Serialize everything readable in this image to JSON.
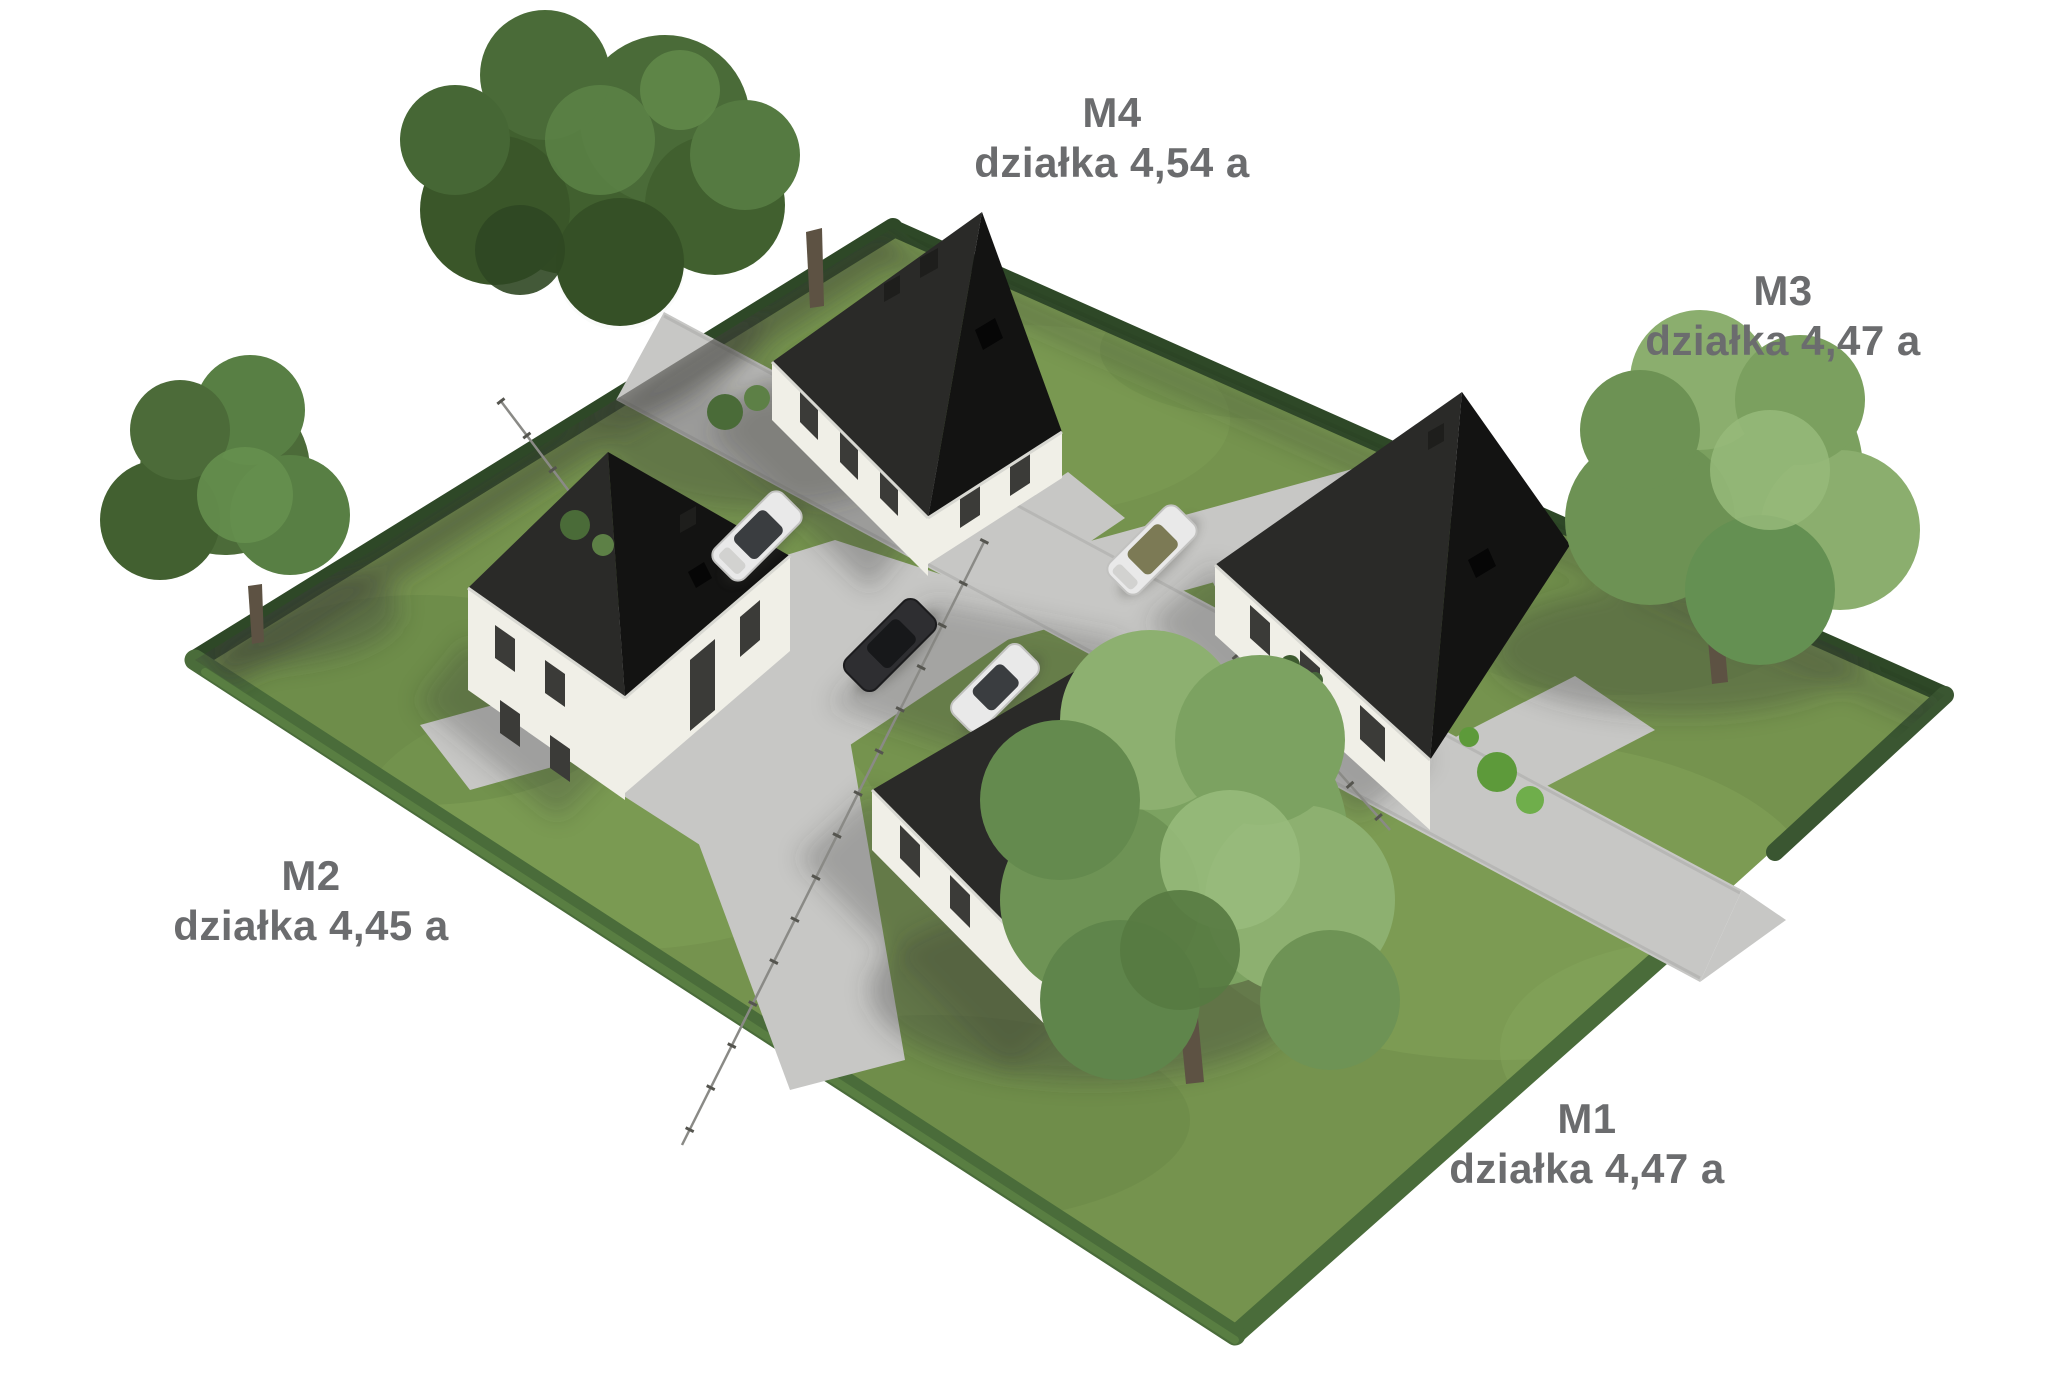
{
  "background": "#ffffff",
  "plots": [
    {
      "id": "M1",
      "label": "M1",
      "area_label": "działka 4,47 a"
    },
    {
      "id": "M2",
      "label": "M2",
      "area_label": "działka 4,45 a"
    },
    {
      "id": "M3",
      "label": "M3",
      "area_label": "działka 4,47 a"
    },
    {
      "id": "M4",
      "label": "M4",
      "area_label": "działka 4,54 a"
    }
  ],
  "colors": {
    "label-text": "#6b6c6e",
    "grass": "#75934e",
    "grass-light": "#8aab5f",
    "grass-dark": "#5e7c40",
    "hedge-dark": "#2e4827",
    "hedge-mid": "#3a5631",
    "hedge-light": "#4a6c3a",
    "roof-dark": "#131312",
    "roof-light": "#2a2a28",
    "wall": "#f0efe7",
    "window": "#3b3b38",
    "road": "#c7c7c5",
    "road-edge": "#b4b4b2",
    "tree-dark": "#4a6b38",
    "tree-mid": "#5d8046",
    "tree-light": "#86ab68",
    "trunk": "#5d5243",
    "car-white": "#e9e9e9",
    "car-dark": "#2e2e31",
    "shadow": "#3c3c38",
    "fence": "#8a8a86"
  }
}
